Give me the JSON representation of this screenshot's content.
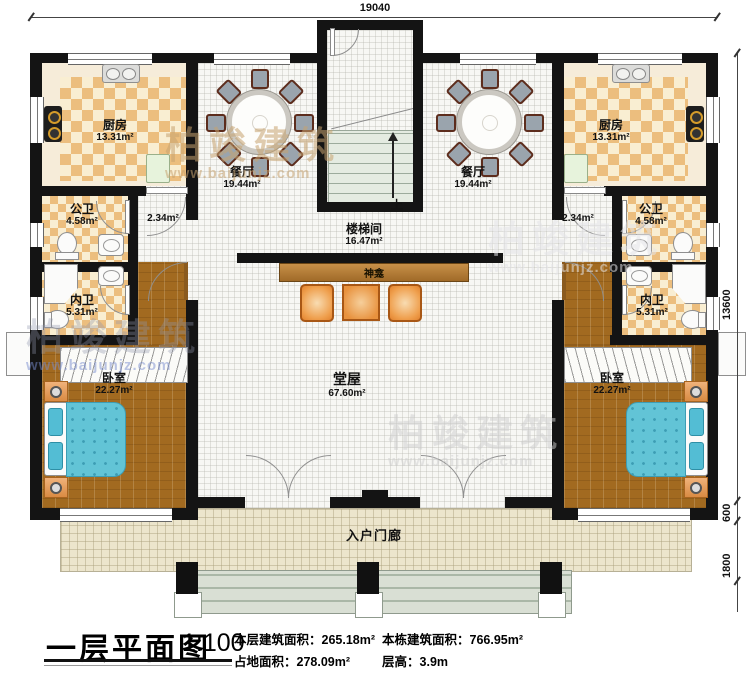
{
  "dimensions": {
    "overall_width": "19040",
    "overall_height": "13600",
    "porch_depth": "600",
    "steps_depth": "1800"
  },
  "rooms": {
    "kitchen_left": {
      "name": "厨房",
      "area": "13.31m²"
    },
    "kitchen_right": {
      "name": "厨房",
      "area": "13.31m²"
    },
    "dining_left": {
      "name": "餐厅",
      "area": "19.44m²"
    },
    "dining_right": {
      "name": "餐厅",
      "area": "19.44m²"
    },
    "public_bath_left": {
      "name": "公卫",
      "area": "4.58m²"
    },
    "public_bath_right": {
      "name": "公卫",
      "area": "4.58m²"
    },
    "corridor_left": {
      "area": "2.34m²"
    },
    "corridor_right": {
      "area": "2.34m²"
    },
    "ensuite_left": {
      "name": "内卫",
      "area": "5.31m²"
    },
    "ensuite_right": {
      "name": "内卫",
      "area": "5.31m²"
    },
    "bedroom_left": {
      "name": "卧室",
      "area": "22.27m²"
    },
    "bedroom_right": {
      "name": "卧室",
      "area": "22.27m²"
    },
    "stair_hall": {
      "name": "楼梯间",
      "area": "16.47m²"
    },
    "main_hall": {
      "name": "堂屋",
      "area": "67.60m²"
    },
    "porch": {
      "name": "入户门廊"
    }
  },
  "annotations": {
    "up": "上",
    "shrine": "神龛"
  },
  "title_block": {
    "title": "一层平面图",
    "scale": "1:100",
    "floor_area_label": "本层建筑面积：",
    "floor_area_value": "265.18m²",
    "land_area_label": "占地面积：",
    "land_area_value": "278.09m²",
    "total_area_label": "本栋建筑面积：",
    "total_area_value": "766.95m²",
    "floor_height_label": "层高：",
    "floor_height_value": "3.9m"
  },
  "watermark": {
    "name": "柏竣建筑",
    "url": "www.baijunjz.com"
  },
  "colors": {
    "wall": "#141414",
    "tile": "#ecbe7e",
    "wood": "#a26a20",
    "bed": "#62c4d6",
    "porch_floor": "#ece5cc",
    "accent_orange": "#e8923e"
  }
}
